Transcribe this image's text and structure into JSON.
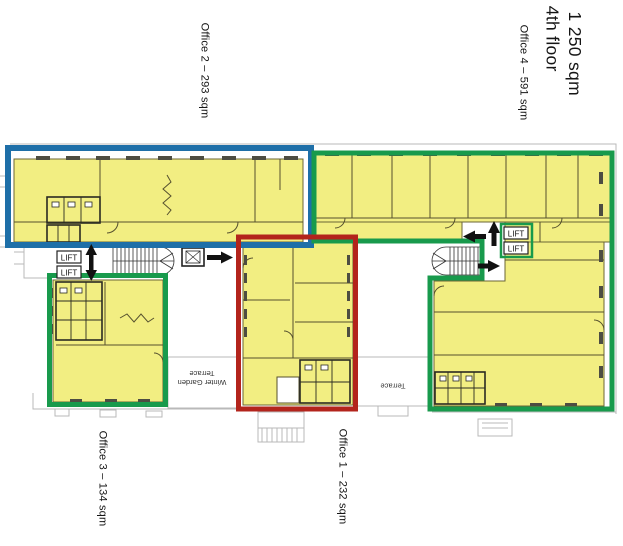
{
  "title": {
    "floor": "4th floor",
    "area": "1 250 sqm"
  },
  "offices": [
    {
      "name": "Office 1",
      "area_sqm": 232,
      "label": "Office 1 – 232 sqm",
      "outline_color": "#B3241C"
    },
    {
      "name": "Office 2",
      "area_sqm": 293,
      "label": "Office 2 – 293 sqm",
      "outline_color": "#1E6FA8"
    },
    {
      "name": "Office 3",
      "area_sqm": 134,
      "label": "Office 3 – 134 sqm",
      "outline_color": "#189A4C"
    },
    {
      "name": "Office 4",
      "area_sqm": 591,
      "label": "Office 4 – 591 sqm",
      "outline_color": "#189A4C"
    }
  ],
  "plan_annotations": {
    "lift": "LIFT",
    "terrace": "Terrace",
    "winter_garden_line1": "Winter Garden",
    "winter_garden_line2": "Terrace"
  },
  "colors": {
    "room_highlight": "#F2EE82",
    "office1_red": "#B3241C",
    "office2_blue": "#1E6FA8",
    "office_green": "#189A4C"
  }
}
